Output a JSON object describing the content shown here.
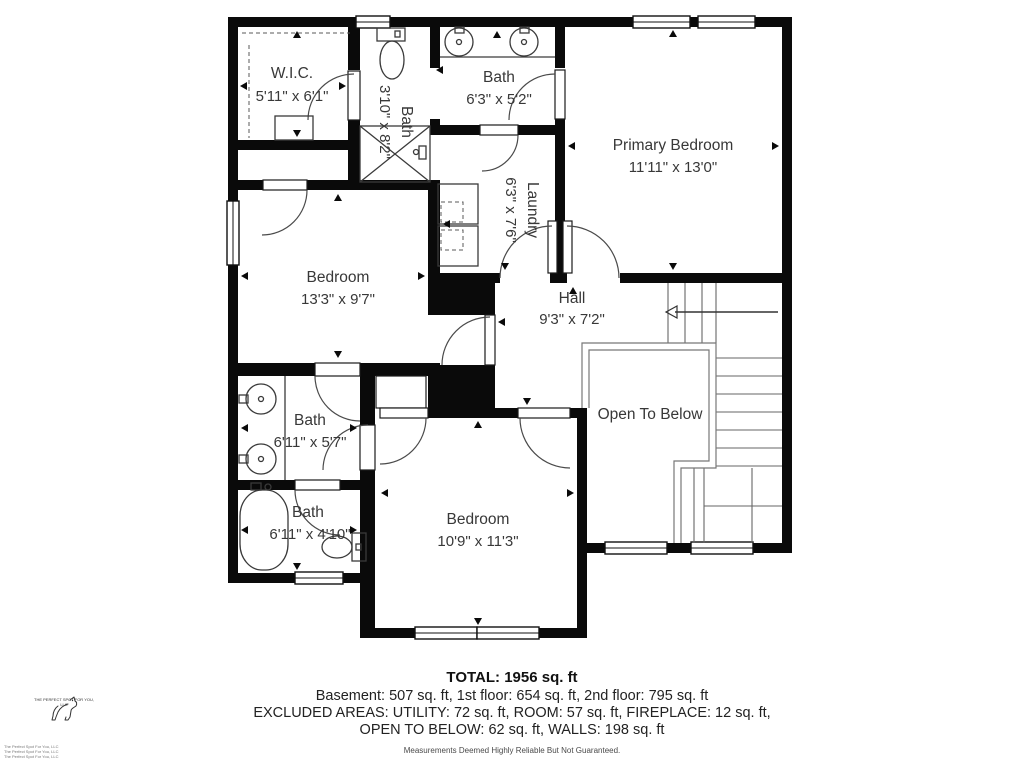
{
  "rooms": {
    "wic": {
      "name": "W.I.C.",
      "dims": "5'11\" x 6'1\""
    },
    "bath_upper": {
      "name": "Bath",
      "dims": "3'10\" x 8'2\""
    },
    "bath_top": {
      "name": "Bath",
      "dims": "6'3\" x 5'2\""
    },
    "primary": {
      "name": "Primary Bedroom",
      "dims": "11'11\" x 13'0\""
    },
    "laundry": {
      "name": "Laundry",
      "dims": "6'3\" x 7'6\""
    },
    "bedroom_left": {
      "name": "Bedroom",
      "dims": "13'3\" x 9'7\""
    },
    "hall": {
      "name": "Hall",
      "dims": "9'3\" x 7'2\""
    },
    "open_below": {
      "name": "Open To Below"
    },
    "bath_mid": {
      "name": "Bath",
      "dims": "6'11\" x 5'7\""
    },
    "bath_lower": {
      "name": "Bath",
      "dims": "6'11\" x 4'10\""
    },
    "bedroom_bottom": {
      "name": "Bedroom",
      "dims": "10'9\" x 11'3\""
    }
  },
  "footer": {
    "total": "TOTAL: 1956 sq. ft",
    "floors": "Basement: 507 sq. ft, 1st floor: 654 sq. ft, 2nd floor: 795 sq. ft",
    "excluded1": "EXCLUDED AREAS: UTILITY: 72 sq. ft, ROOM: 57 sq. ft, FIREPLACE: 12 sq. ft,",
    "excluded2": "OPEN TO BELOW: 62 sq. ft, WALLS: 198 sq. ft",
    "disclaimer": "Measurements Deemed Highly Reliable But Not Guaranteed."
  },
  "branding": {
    "logo_caption": "THE PERFECT SPOT FOR YOU, LLC",
    "corner_lines": [
      "The Perfect Spot For You, LLC",
      "The Perfect Spot For You, LLC",
      "The Perfect Spot For You, LLC"
    ]
  },
  "colors": {
    "wall": "#0a0a0a",
    "line": "#4a4a4a",
    "label": "#383838"
  }
}
